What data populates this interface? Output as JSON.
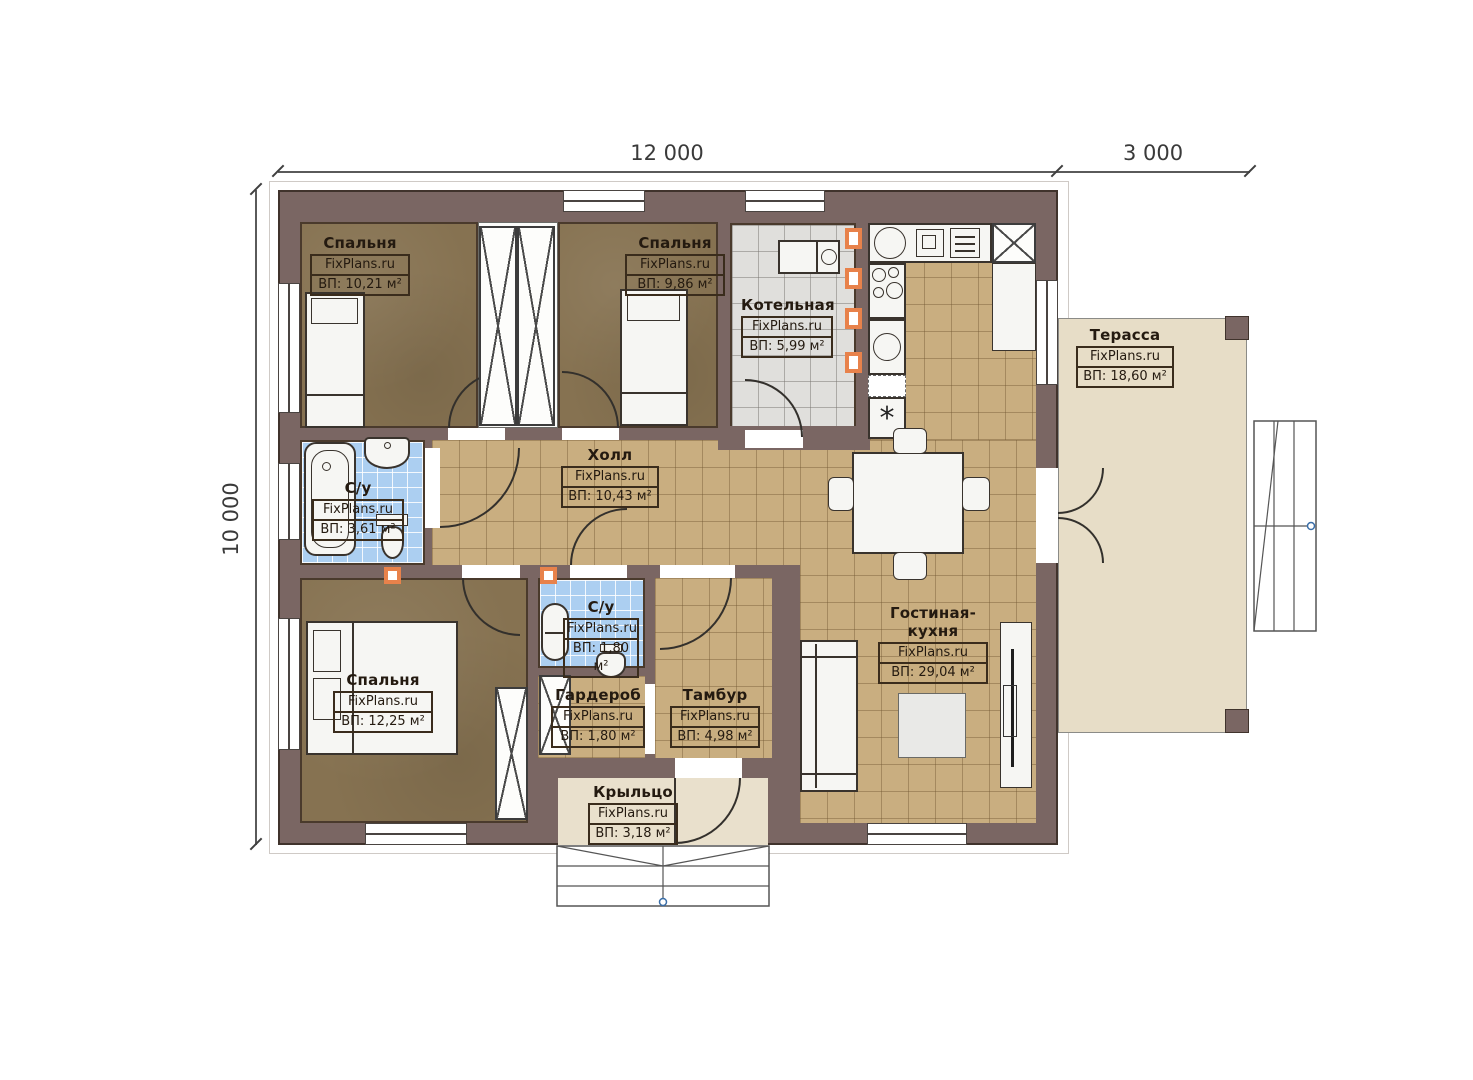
{
  "plan": {
    "dimensions": {
      "width_main": "12 000",
      "width_terrace": "3 000",
      "height": "10 000"
    },
    "rooms": {
      "bedroom1": {
        "name": "Спальня",
        "brand": "FixPlans.ru",
        "area": "ВП: 10,21 м²"
      },
      "bedroom2": {
        "name": "Спальня",
        "brand": "FixPlans.ru",
        "area": "ВП: 9,86 м²"
      },
      "boiler": {
        "name": "Котельная",
        "brand": "FixPlans.ru",
        "area": "ВП: 5,99 м²"
      },
      "terrace": {
        "name": "Терасса",
        "brand": "FixPlans.ru",
        "area": "ВП: 18,60 м²"
      },
      "bath1": {
        "name": "С/у",
        "brand": "FixPlans.ru",
        "area": "ВП: 3,61 м²"
      },
      "hall": {
        "name": "Холл",
        "brand": "FixPlans.ru",
        "area": "ВП: 10,43 м²"
      },
      "bedroom3": {
        "name": "Спальня",
        "brand": "FixPlans.ru",
        "area": "ВП: 12,25 м²"
      },
      "bath2": {
        "name": "С/у",
        "brand": "FixPlans.ru",
        "area": "ВП: 1,80 м²"
      },
      "wardrobe": {
        "name": "Гардероб",
        "brand": "FixPlans.ru",
        "area": "ВП: 1,80 м²"
      },
      "tambur": {
        "name": "Тамбур",
        "brand": "FixPlans.ru",
        "area": "ВП: 4,98 м²"
      },
      "living": {
        "name": "Гостиная-кухня",
        "brand": "FixPlans.ru",
        "area": "ВП: 29,04 м²"
      },
      "porch": {
        "name": "Крыльцо",
        "brand": "FixPlans.ru",
        "area": "ВП: 3,18 м²"
      }
    },
    "icons": {
      "washer_asterisk": "*"
    },
    "colors": {
      "wall": "#7a6663",
      "floor_wood": "#867251",
      "floor_tile_tan": "#c9ae80",
      "floor_tile_blue": "#accff1",
      "floor_tile_gray": "#e0dfdc",
      "terrace": "#e6dcc6",
      "marker_orange": "#e8824b"
    }
  }
}
